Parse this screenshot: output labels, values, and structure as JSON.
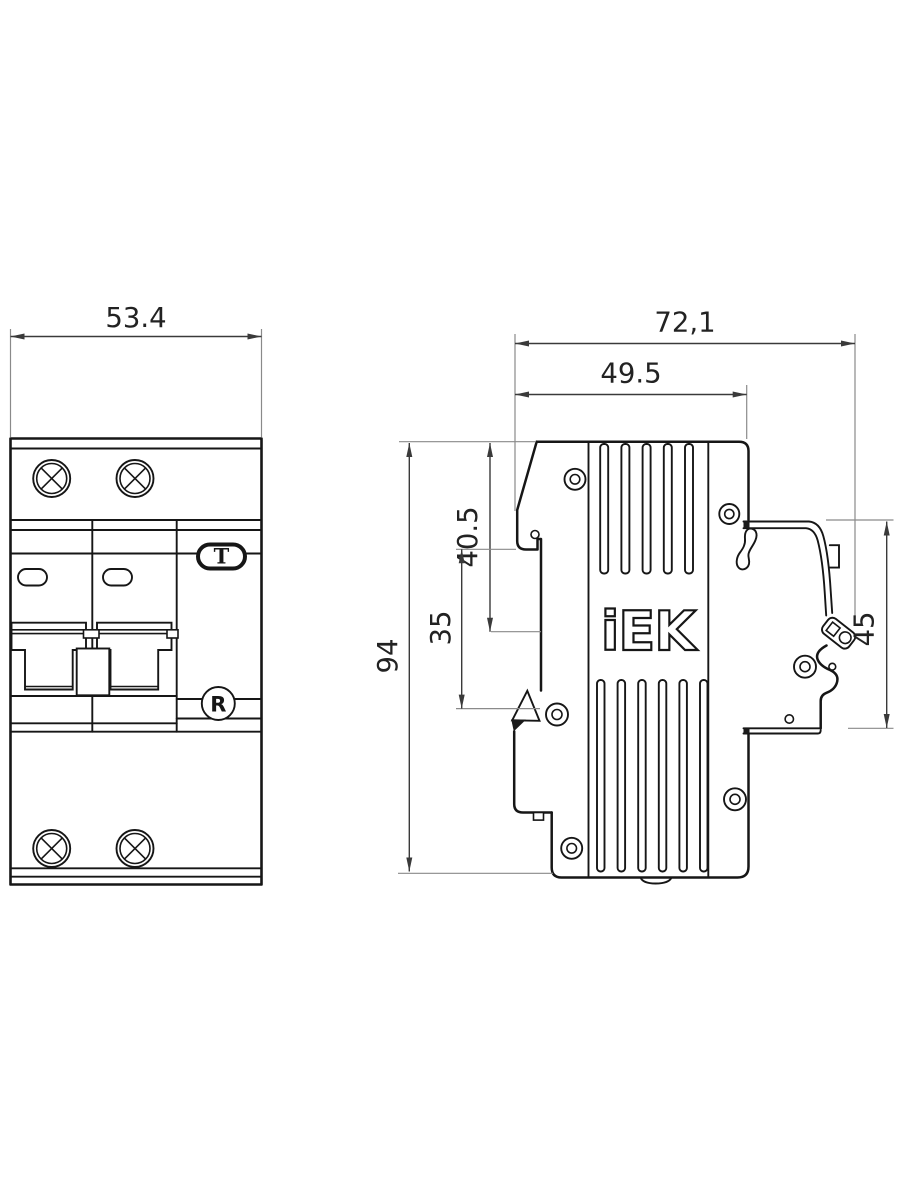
{
  "drawing": {
    "front_view": {
      "width_mm": "53.4",
      "test_button_label": "T",
      "registered_mark": "R"
    },
    "side_view": {
      "logo": "iEK",
      "overall_depth_mm": "72,1",
      "upper_depth_mm": "49.5",
      "top_to_rail_mm": "40.5",
      "front_step_mm": "35",
      "overall_height_mm": "94",
      "rear_clip_height_mm": "45"
    },
    "colors": {
      "outline": "#161616",
      "dimension": "#3a3a3a",
      "extension": "#8a8a8a",
      "background": "#ffffff"
    }
  }
}
